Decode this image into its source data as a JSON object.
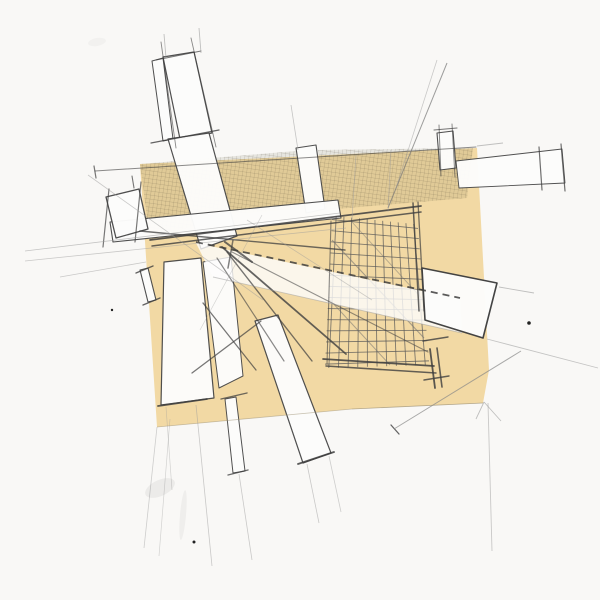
{
  "meta": {
    "description": "Hand-drawn architectural concept sketch: pencil construction lines, white bar shapes and a crosshatched grid over a tan paper overlay",
    "canvas": {
      "width": 600,
      "height": 600
    }
  },
  "palette": {
    "paper": "#f9f8f6",
    "tan": "#f2d9a4",
    "hatch_base": "rgba(110,98,66,0.13)",
    "hatch_line": "rgba(80,72,50,0.45)",
    "bar_fill": "#fdfdfc",
    "bar_stroke": "#4a4a4a",
    "pencil_dark": "#3f3f3f",
    "pencil_mid": "#6b6b6b",
    "pencil_faint": "#9a9a9a",
    "grid_line": "#575757",
    "band_fill": "rgba(253,253,252,0.8)",
    "tan_edge": "#9a8d6f"
  },
  "sketch": {
    "tan_polygon": {
      "name": "tan-paper-overlay",
      "points": [
        [
          140,
          164
        ],
        [
          477,
          148
        ],
        [
          489,
          370
        ],
        [
          483,
          403
        ],
        [
          352,
          409
        ],
        [
          157,
          427
        ]
      ]
    },
    "hatch_regions": [
      {
        "name": "hatch-region-left",
        "points": [
          [
            140,
            164
          ],
          [
            296,
            151
          ],
          [
            308,
            208
          ],
          [
            230,
            214
          ],
          [
            150,
            240
          ]
        ]
      },
      {
        "name": "hatch-region-right",
        "points": [
          [
            318,
            150
          ],
          [
            473,
            148
          ],
          [
            467,
            198
          ],
          [
            325,
            210
          ]
        ]
      }
    ],
    "grid": {
      "name": "crosshatch-grid",
      "tl": [
        336,
        220
      ],
      "tr": [
        414,
        228
      ],
      "br": [
        425,
        361
      ],
      "bl": [
        329,
        364
      ],
      "cols": 10,
      "rows": 13,
      "overshoot": 4
    },
    "grid_diagonals": [
      [
        332,
        240,
        424,
        338,
        1.1,
        0.55
      ],
      [
        330,
        300,
        390,
        365,
        1.0,
        0.5
      ],
      [
        352,
        222,
        425,
        302,
        0.9,
        0.45
      ]
    ],
    "bars": [
      {
        "name": "bar-top-rect",
        "points": [
          [
            163,
            57
          ],
          [
            194,
            52
          ],
          [
            212,
            133
          ],
          [
            180,
            139
          ]
        ],
        "sw": 1.2
      },
      {
        "name": "bar-top-strip",
        "points": [
          [
            152,
            61
          ],
          [
            163,
            58
          ],
          [
            173,
            139
          ],
          [
            163,
            141
          ]
        ],
        "sw": 1.0
      },
      {
        "name": "bar-upper-diagonal",
        "points": [
          [
            168,
            139
          ],
          [
            209,
            133
          ],
          [
            237,
            236
          ],
          [
            201,
            249
          ]
        ],
        "sw": 1.2
      },
      {
        "name": "bar-vertical-strip",
        "points": [
          [
            296,
            148
          ],
          [
            316,
            145
          ],
          [
            325,
            209
          ],
          [
            306,
            213
          ]
        ],
        "sw": 1.1
      },
      {
        "name": "bar-spine-band",
        "points": [
          [
            110,
            222
          ],
          [
            338,
            200
          ],
          [
            341,
            218
          ],
          [
            113,
            242
          ]
        ],
        "sw": 1.1
      },
      {
        "name": "bar-left-cap",
        "points": [
          [
            106,
            197
          ],
          [
            139,
            189
          ],
          [
            148,
            229
          ],
          [
            116,
            238
          ]
        ],
        "sw": 1.3
      },
      {
        "name": "bar-tall-left",
        "points": [
          [
            164,
            262
          ],
          [
            201,
            258
          ],
          [
            214,
            398
          ],
          [
            161,
            405
          ]
        ],
        "sw": 1.2
      },
      {
        "name": "bar-tall-left-2",
        "points": [
          [
            203,
            262
          ],
          [
            231,
            257
          ],
          [
            243,
            376
          ],
          [
            219,
            388
          ]
        ],
        "sw": 1.0
      },
      {
        "name": "bar-lower-diagonal",
        "points": [
          [
            255,
            321
          ],
          [
            278,
            315
          ],
          [
            331,
            453
          ],
          [
            303,
            463
          ]
        ],
        "sw": 1.2
      },
      {
        "name": "bar-thin-strip",
        "points": [
          [
            225,
            399
          ],
          [
            236,
            397
          ],
          [
            245,
            471
          ],
          [
            233,
            473
          ]
        ],
        "sw": 1.0
      },
      {
        "name": "bar-small-stick",
        "points": [
          [
            140,
            270
          ],
          [
            148,
            268
          ],
          [
            156,
            300
          ],
          [
            148,
            302
          ]
        ],
        "sw": 1.1
      },
      {
        "name": "bar-small-rect-top",
        "points": [
          [
            437,
            133
          ],
          [
            453,
            131
          ],
          [
            456,
            168
          ],
          [
            440,
            170
          ]
        ],
        "sw": 1.1
      },
      {
        "name": "bar-right-beam",
        "points": [
          [
            456,
            161
          ],
          [
            562,
            149
          ],
          [
            565,
            183
          ],
          [
            459,
            188
          ]
        ],
        "sw": 0.9
      }
    ],
    "band_overlay": {
      "name": "white-band-overlay",
      "points": [
        [
          196,
          243
        ],
        [
          460,
          299
        ],
        [
          462,
          333
        ],
        [
          213,
          277
        ]
      ]
    },
    "parallelogram": {
      "name": "white-parallelogram-right",
      "points": [
        [
          422,
          268
        ],
        [
          497,
          283
        ],
        [
          483,
          338
        ],
        [
          425,
          320
        ]
      ],
      "sw": 1.6
    },
    "beams": [
      [
        150,
        240,
        421,
        206,
        1.7,
        0.85
      ],
      [
        152,
        246,
        421,
        212,
        1.5,
        0.8
      ],
      [
        140,
        231,
        345,
        250,
        1.4,
        0.75
      ],
      [
        413,
        203,
        419,
        311,
        1.5,
        0.8
      ],
      [
        418,
        202,
        424,
        311,
        1.3,
        0.7
      ],
      [
        323,
        359,
        434,
        366,
        1.7,
        0.85
      ],
      [
        326,
        366,
        436,
        373,
        1.5,
        0.8
      ],
      [
        331,
        221,
        327,
        364,
        1.1,
        0.6
      ],
      [
        430,
        349,
        435,
        388,
        1.8,
        0.85
      ],
      [
        437,
        348,
        442,
        387,
        1.6,
        0.8
      ],
      [
        423,
        341,
        448,
        337,
        1.4,
        0.8
      ],
      [
        424,
        380,
        449,
        376,
        1.4,
        0.8
      ],
      [
        222,
        247,
        346,
        354,
        1.8,
        0.8
      ],
      [
        227,
        252,
        312,
        361,
        1.4,
        0.7
      ],
      [
        217,
        258,
        284,
        361,
        1.2,
        0.6
      ],
      [
        232,
        252,
        428,
        352,
        1.1,
        0.55
      ],
      [
        203,
        303,
        256,
        370,
        1.3,
        0.7
      ],
      [
        192,
        373,
        261,
        321,
        1.3,
        0.7
      ],
      [
        225,
        242,
        252,
        262,
        2.0,
        0.75
      ],
      [
        233,
        240,
        228,
        268,
        1.5,
        0.65
      ],
      [
        158,
        406,
        207,
        399,
        1.8,
        0.85
      ],
      [
        298,
        464,
        334,
        452,
        1.8,
        0.85
      ],
      [
        221,
        399,
        247,
        393,
        1.4,
        0.75
      ],
      [
        228,
        475,
        248,
        470,
        1.4,
        0.75
      ],
      [
        136,
        273,
        153,
        266,
        1.4,
        0.8
      ],
      [
        143,
        305,
        160,
        298,
        1.4,
        0.8
      ],
      [
        539,
        147,
        542,
        190,
        1.2,
        0.75
      ],
      [
        561,
        144,
        565,
        191,
        1.2,
        0.75
      ],
      [
        434,
        130,
        457,
        128,
        1.1,
        0.7
      ],
      [
        439,
        125,
        441,
        176,
        1.0,
        0.6
      ],
      [
        452,
        124,
        455,
        177,
        1.0,
        0.6
      ],
      [
        109,
        189,
        103,
        247,
        1.2,
        0.7
      ],
      [
        141,
        182,
        135,
        242,
        1.2,
        0.7
      ],
      [
        156,
        60,
        201,
        51,
        1.0,
        0.7
      ],
      [
        161,
        42,
        176,
        148,
        0.9,
        0.6
      ],
      [
        191,
        38,
        216,
        147,
        0.9,
        0.6
      ],
      [
        151,
        143,
        219,
        130,
        1.3,
        0.8
      ],
      [
        95,
        171,
        476,
        147,
        1.0,
        0.6
      ],
      [
        94,
        166,
        96,
        178,
        1.2,
        0.7
      ],
      [
        132,
        176,
        134,
        188,
        1.1,
        0.7
      ],
      [
        391,
        425,
        399,
        434,
        1.3,
        0.8
      ]
    ],
    "dashed_lines": [
      {
        "seg": [
          196,
          242,
          460,
          298
        ],
        "w": 1.8,
        "o": 0.85,
        "dash": "7 5"
      }
    ],
    "faint_lines": [
      [
        25,
        251,
        340,
        213,
        0.8,
        0.55
      ],
      [
        25,
        261,
        346,
        228,
        0.8,
        0.5
      ],
      [
        60,
        277,
        146,
        262,
        0.8,
        0.5
      ],
      [
        88,
        175,
        263,
        300,
        0.8,
        0.5
      ],
      [
        447,
        63,
        388,
        208,
        1.0,
        0.7,
        "#777777"
      ],
      [
        437,
        60,
        396,
        188,
        0.8,
        0.5
      ],
      [
        477,
        146,
        503,
        143,
        0.9,
        0.6
      ],
      [
        499,
        287,
        534,
        293,
        0.9,
        0.6
      ],
      [
        487,
        339,
        598,
        368,
        0.9,
        0.55
      ],
      [
        488,
        403,
        492,
        551,
        0.9,
        0.5
      ],
      [
        484,
        402,
        501,
        421,
        0.9,
        0.6
      ],
      [
        484,
        402,
        476,
        419,
        0.9,
        0.6
      ],
      [
        521,
        351,
        394,
        429,
        1.0,
        0.7,
        "#888888"
      ],
      [
        196,
        405,
        212,
        566,
        0.8,
        0.5
      ],
      [
        166,
        407,
        172,
        490,
        0.7,
        0.4
      ],
      [
        239,
        474,
        252,
        560,
        0.8,
        0.5
      ],
      [
        157,
        427,
        144,
        548,
        0.8,
        0.45
      ],
      [
        170,
        419,
        159,
        556,
        0.7,
        0.4
      ],
      [
        307,
        464,
        319,
        523,
        0.8,
        0.5
      ],
      [
        329,
        456,
        341,
        512,
        0.8,
        0.45
      ],
      [
        164,
        34,
        166,
        58,
        0.9,
        0.6
      ],
      [
        199,
        28,
        201,
        53,
        0.9,
        0.6
      ],
      [
        291,
        105,
        298,
        150,
        0.8,
        0.55
      ],
      [
        356,
        155,
        352,
        219,
        0.8,
        0.5
      ],
      [
        391,
        150,
        388,
        212,
        0.8,
        0.5
      ],
      [
        213,
        277,
        462,
        333,
        0.9,
        0.5
      ],
      [
        247,
        220,
        372,
        300,
        0.8,
        0.45
      ],
      [
        262,
        215,
        200,
        330,
        0.7,
        0.4
      ],
      [
        352,
        409,
        483,
        403,
        0.8,
        0.7,
        "#9a8d6f"
      ],
      [
        157,
        427,
        352,
        409,
        0.8,
        0.5,
        "#9a8d6f"
      ]
    ],
    "dots": [
      {
        "name": "ink-speck",
        "x": 529,
        "y": 323,
        "r": 1.8
      },
      {
        "name": "ink-speck",
        "x": 194,
        "y": 542,
        "r": 1.5
      },
      {
        "name": "ink-speck",
        "x": 112,
        "y": 310,
        "r": 1.2
      }
    ],
    "smudges": [
      {
        "name": "graphite-smudge",
        "cx": 160,
        "cy": 488,
        "rx": 16,
        "ry": 8,
        "rot": -25,
        "o": 0.08
      },
      {
        "name": "graphite-smudge",
        "cx": 183,
        "cy": 515,
        "rx": 3,
        "ry": 25,
        "rot": 5,
        "o": 0.06
      },
      {
        "name": "graphite-smudge",
        "cx": 97,
        "cy": 42,
        "rx": 9,
        "ry": 4,
        "rot": -10,
        "o": 0.04
      }
    ]
  }
}
